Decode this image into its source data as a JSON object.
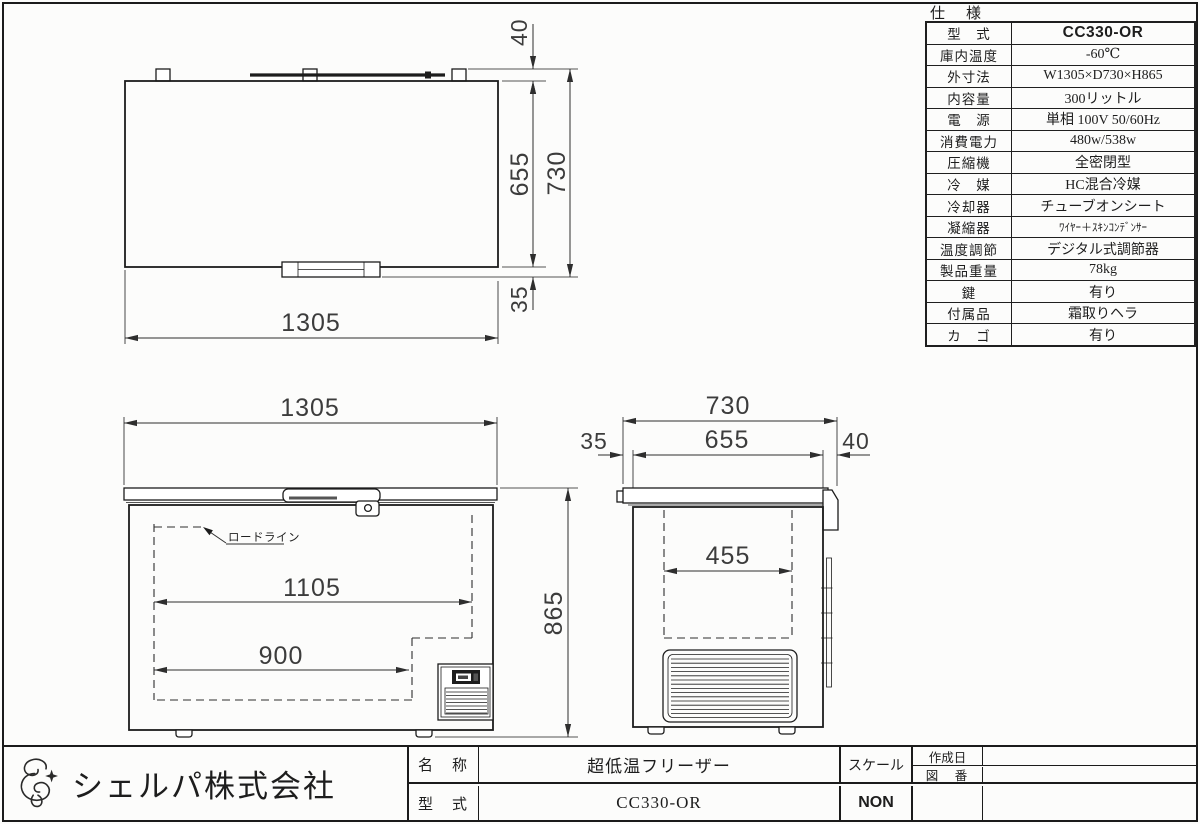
{
  "dims": {
    "top_width": "1305",
    "top_depth": "655",
    "top_total": "730",
    "top_back": "40",
    "top_front": "35",
    "front_width": "1305",
    "front_inner": "1105",
    "front_lower": "900",
    "front_height": "865",
    "side_total": "730",
    "side_inner": "655",
    "side_front": "35",
    "side_back": "40",
    "side_basket": "455",
    "load_line": "ロードライン"
  },
  "spec": {
    "title": "仕　様",
    "rows": [
      {
        "label": "型　式",
        "value": "CC330-OR"
      },
      {
        "label": "庫内温度",
        "value": "-60℃"
      },
      {
        "label": "外寸法",
        "value": "W1305×D730×H865"
      },
      {
        "label": "内容量",
        "value": "300リットル"
      },
      {
        "label": "電　源",
        "value": "単相 100V 50/60Hz"
      },
      {
        "label": "消費電力",
        "value": "480w/538w"
      },
      {
        "label": "圧縮機",
        "value": "全密閉型"
      },
      {
        "label": "冷　媒",
        "value": "HC混合冷媒"
      },
      {
        "label": "冷却器",
        "value": "チューブオンシート"
      },
      {
        "label": "凝縮器",
        "value": "ﾜｲﾔｰ＋ｽｷﾝｺﾝﾃﾞﾝｻｰ"
      },
      {
        "label": "温度調節",
        "value": "デジタル式調節器"
      },
      {
        "label": "製品重量",
        "value": "78kg"
      },
      {
        "label": "鍵",
        "value": "有り"
      },
      {
        "label": "付属品",
        "value": "霜取りヘラ"
      },
      {
        "label": "カ　ゴ",
        "value": "有り"
      }
    ]
  },
  "title_block": {
    "company": "シェルパ株式会社",
    "name_label": "名　称",
    "name_value": "超低温フリーザー",
    "model_label": "型　式",
    "model_value": "CC330-OR",
    "scale_label": "スケール",
    "scale_value": "NON",
    "date_label": "作成日",
    "drawing_no_label": "図　番"
  }
}
